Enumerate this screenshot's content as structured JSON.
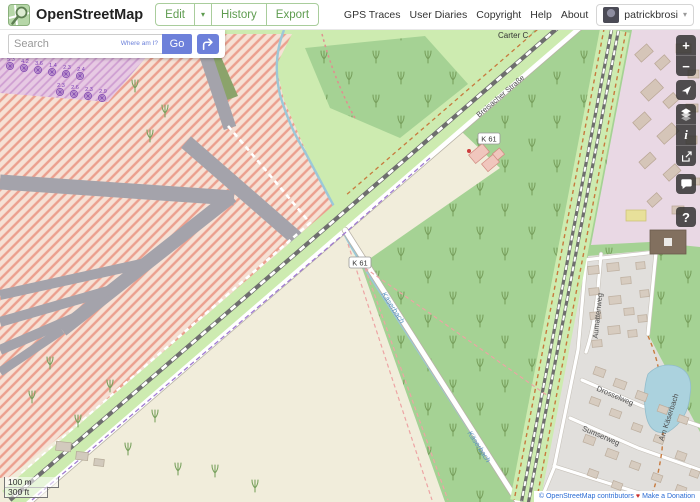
{
  "header": {
    "title": "OpenStreetMap",
    "nav": {
      "edit": "Edit",
      "history": "History",
      "export": "Export"
    },
    "links": {
      "gps_traces": "GPS Traces",
      "user_diaries": "User Diaries",
      "copyright": "Copyright",
      "help": "Help",
      "about": "About"
    },
    "user": {
      "name": "patrickbrosi"
    }
  },
  "search": {
    "placeholder": "Search",
    "where_am_i": "Where am I?",
    "go_label": "Go"
  },
  "controls": {
    "zoom_in": "+",
    "zoom_out": "−",
    "legend": "i",
    "query": "?"
  },
  "map": {
    "badge_k61": "K 61",
    "place_label": "Carter C",
    "street_breisacher": "Breisacher Straße",
    "street_aumatten": "Aumattenweg",
    "street_drossel": "Drosselweg",
    "street_sumser": "Sumserweg",
    "street_am_kaeserbach": "Am Käserbach",
    "stream": "Käserbach",
    "allotment_numbers": [
      "5.3",
      "4.2",
      "3.6",
      "1.4",
      "2.3",
      "2.4",
      "2.3",
      "2.6",
      "2.3",
      "2.9"
    ]
  },
  "scale": {
    "metric": "100 m",
    "imperial": "300 ft"
  },
  "attribution": {
    "copyright": "© OpenStreetMap contributors",
    "heart": "♥",
    "donate": "Make a Donation"
  },
  "colors": {
    "osm_green": "#5f9c50",
    "button_blue": "#6d80da",
    "forest": "#a5d294",
    "grass": "#cdebb0",
    "hatch_stripe": "#eb9f8e",
    "residential_pink": "#e9d8e4",
    "water": "#abd2de"
  }
}
